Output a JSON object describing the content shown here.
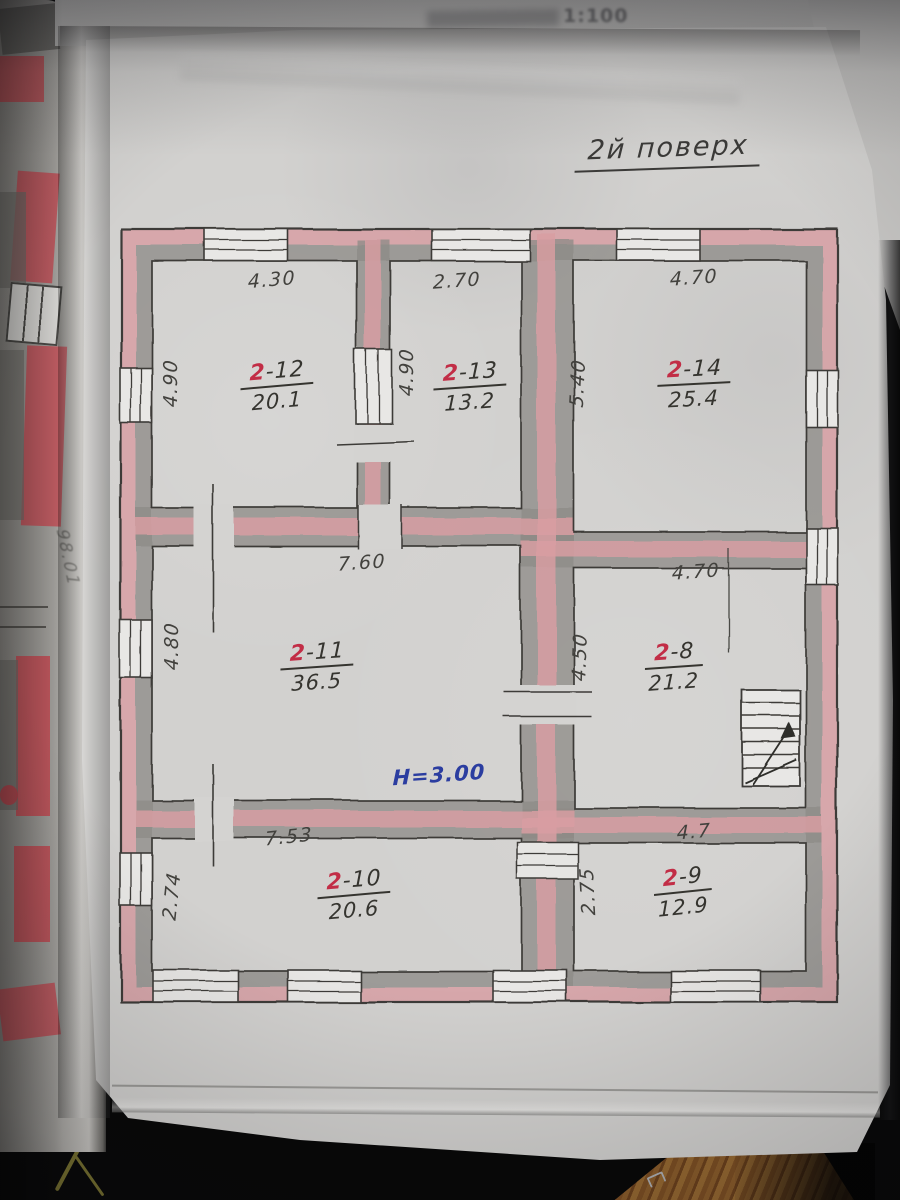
{
  "photo": {
    "faint_scale_text": "1:100",
    "title": "2й поверх",
    "height_note": "Н=3.00",
    "side_page_note": "98.01"
  },
  "plan": {
    "legend": {
      "wall_fill_pink": "#d89da2",
      "wall_fill_gray": "#8e8c88",
      "ink": "#3c3b37",
      "room_number_red": "#c22d46",
      "height_note_blue": "#2b3da0"
    },
    "rooms": [
      {
        "number_prefix": "2",
        "number_suffix": "-12",
        "area": "20.1",
        "width_label": "4.30",
        "height_label": "4.90"
      },
      {
        "number_prefix": "2",
        "number_suffix": "-13",
        "area": "13.2",
        "width_label": "2.70",
        "height_label": "4.90"
      },
      {
        "number_prefix": "2",
        "number_suffix": "-14",
        "area": "25.4",
        "width_label": "4.70",
        "height_label": "5.40"
      },
      {
        "number_prefix": "2",
        "number_suffix": "-11",
        "area": "36.5",
        "width_label": "7.60",
        "height_label": "4.80"
      },
      {
        "number_prefix": "2",
        "number_suffix": "-8",
        "area": "21.2",
        "width_label": "4.70",
        "height_label": "4.50"
      },
      {
        "number_prefix": "2",
        "number_suffix": "-10",
        "area": "20.6",
        "width_label": "7.53",
        "height_label": "2.74"
      },
      {
        "number_prefix": "2",
        "number_suffix": "-9",
        "area": "12.9",
        "width_label": "4.7",
        "height_label": "2.75"
      }
    ]
  }
}
